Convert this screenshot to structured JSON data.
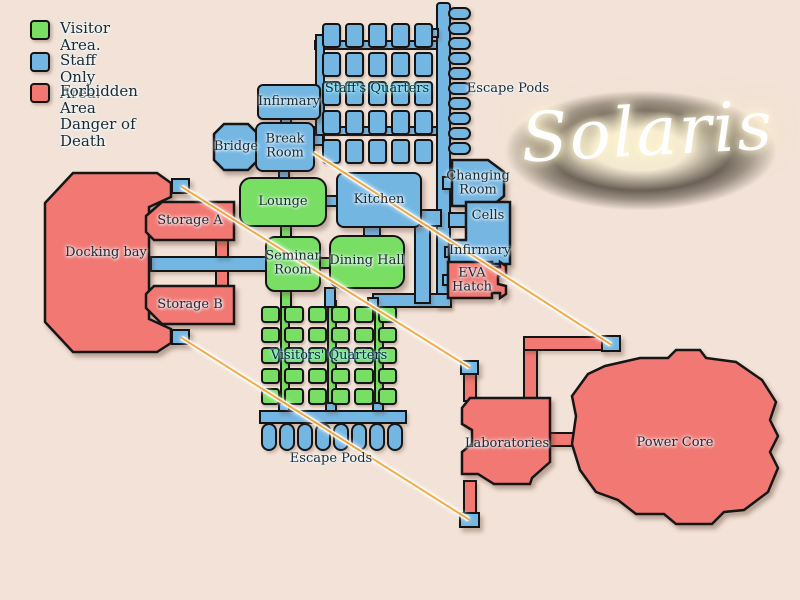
{
  "title": "Solaris",
  "legend": {
    "visitor": "Visitor Area.",
    "staff": "Staff Only Area.",
    "forbidden_line1": "Forbidden Area",
    "forbidden_line2": "Danger of Death"
  },
  "rooms": {
    "staff_quarters": "Staff's Quarters",
    "infirmary_top": "Infirmary",
    "bridge": "Bridge",
    "break_room": "Break Room",
    "changing_room": "Changing Room",
    "lounge": "Lounge",
    "kitchen": "Kitchen",
    "cells": "Cells",
    "infirmary_right": "Infirmary",
    "eva_hatch": "EVA Hatch",
    "docking_bay": "Docking bay",
    "storage_a": "Storage A",
    "storage_b": "Storage B",
    "seminar_room": "Seminar Room",
    "dining_hall": "Dining Hall",
    "visitors_quarters": "Visitors' Quarters",
    "laboratories": "Laboratories",
    "power_core": "Power Core"
  },
  "labels": {
    "escape_pods_top": "Escape Pods",
    "escape_pods_bottom": "Escape Pods"
  },
  "counts": {
    "staff_cells": "25",
    "visitor_cells": "30",
    "pods_top": "10",
    "pods_bottom": "8"
  },
  "colors": {
    "visitor_area": "#78DE64",
    "staff_area": "#74B6E2",
    "forbidden_area": "#F17873",
    "background": "#F2E2D7",
    "outline": "#141414",
    "beam_core": "#F3A63C",
    "label_glow": "#8EF2FF"
  }
}
